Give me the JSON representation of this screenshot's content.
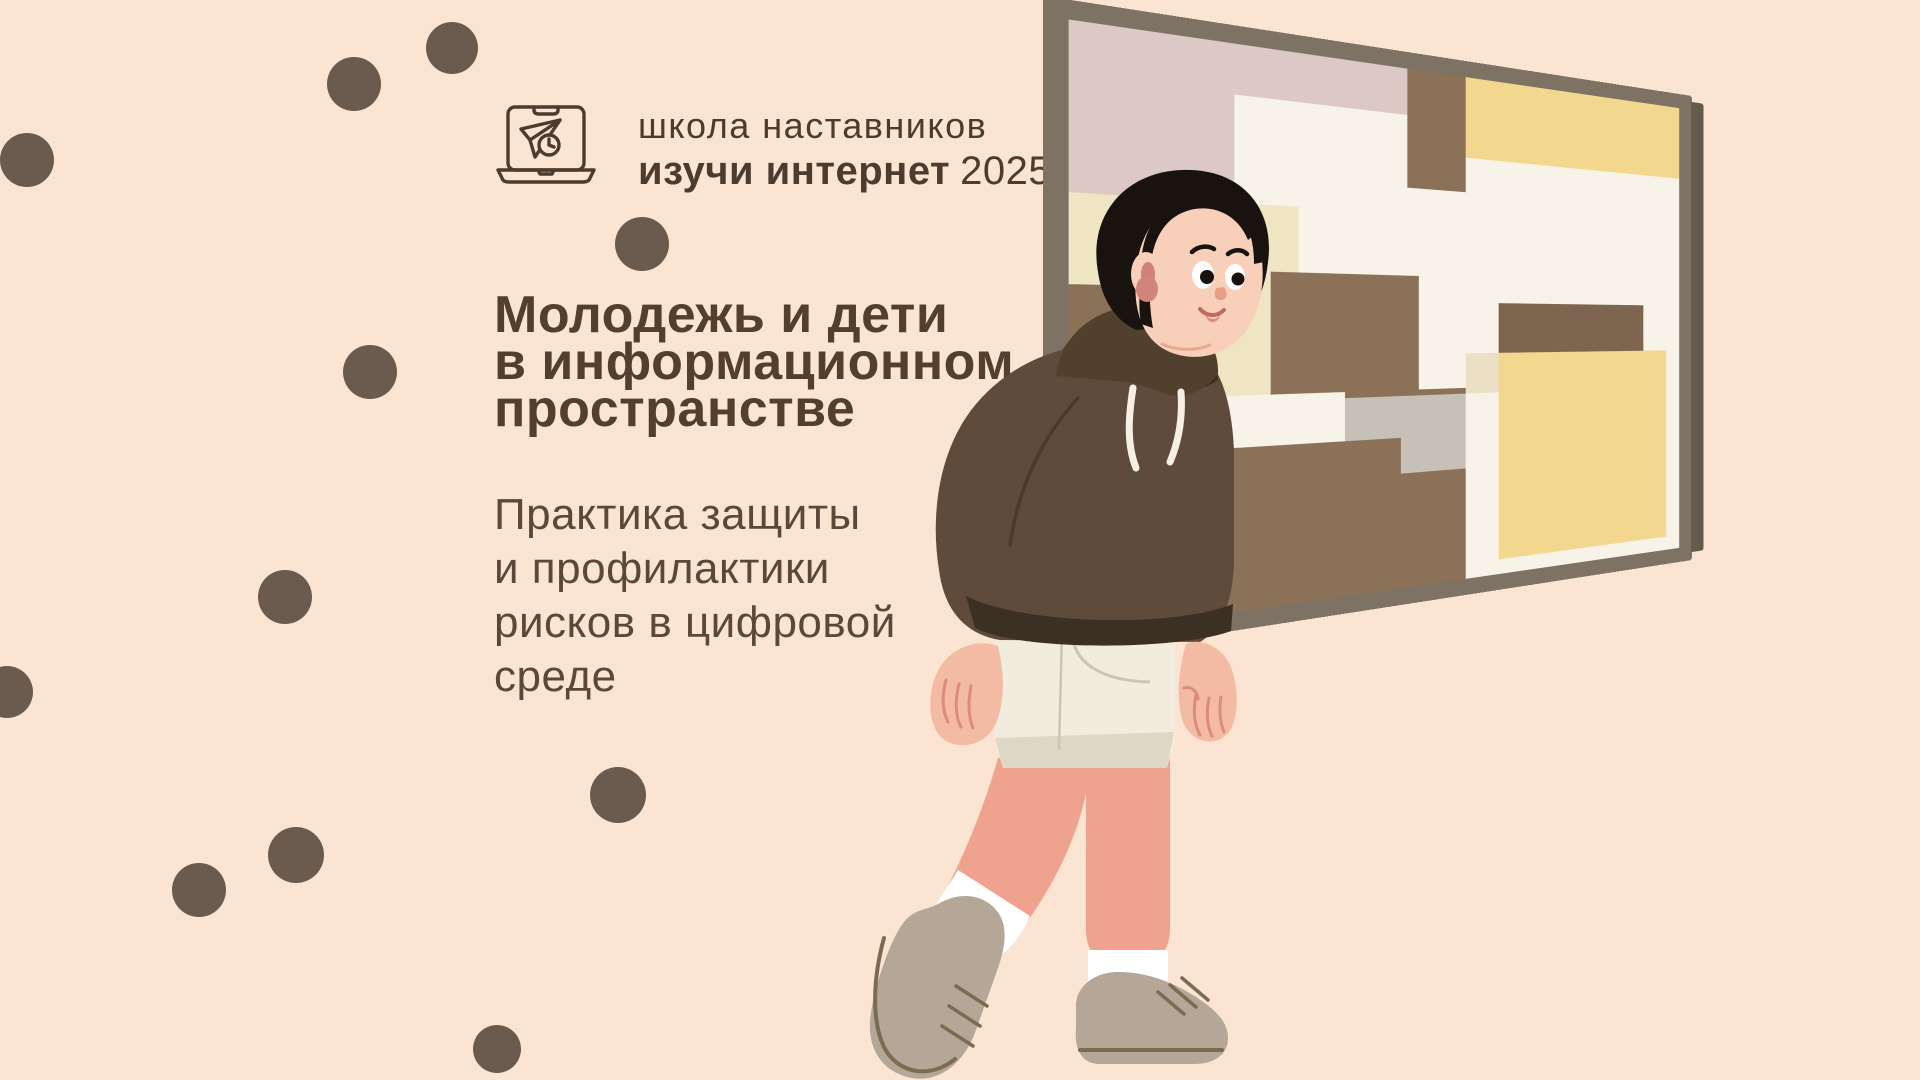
{
  "header": {
    "logo_icon": "laptop-paper-plane-clock",
    "line1": "школа наставников",
    "line2_bold": "изучи интернет",
    "line2_year": "2025"
  },
  "title": {
    "lines": [
      "Молодежь и дети",
      "в информационном",
      "пространстве"
    ]
  },
  "subtitle": {
    "lines": [
      "Практика защиты",
      "и профилактики",
      "рисков в цифровой",
      "среде"
    ]
  },
  "illustration": {
    "description": "boy in brown hoodie and cream shorts walking while looking at abstract painting"
  },
  "colors": {
    "bg": "#fce4d2",
    "dot": "#6b5b4e",
    "header_text": "#4c3b2f",
    "title_text": "#533f30",
    "subtitle_text": "#5c483b",
    "hair": "#191310",
    "skin_face": "#f8cfb9",
    "skin_hand": "#f3bba4",
    "skin_leg": "#efa28e",
    "blush": "#d2837a",
    "ear_inner": "#cf8276",
    "finger_line": "#dc8b7c",
    "hoodie": "#5e4b3b",
    "hood": "#52402f",
    "hoodie_dark": "#3c2f24",
    "string": "#f6f0e4",
    "shorts": "#f1ecdd",
    "shorts_hem": "#ddd8c5",
    "shorts_line": "#ccc6b1",
    "sock": "#ffffff",
    "shoe": "#b4a797",
    "shoe_line": "#7c6a51",
    "frame": "#7d7264",
    "frame_side": "#655b4c",
    "canvas": "#f8f3e8",
    "mouth_line": "#c4685f",
    "lip": "#d98c84",
    "nose": "#e79d86",
    "chin_line": "#e8a88f",
    "crease": "#4a3a2d"
  },
  "decor": {
    "dots": [
      {
        "x": 354,
        "y": 84,
        "r": 27
      },
      {
        "x": 452,
        "y": 48,
        "r": 26
      },
      {
        "x": 27,
        "y": 160,
        "r": 27
      },
      {
        "x": 370,
        "y": 372,
        "r": 27
      },
      {
        "x": 642,
        "y": 244,
        "r": 27
      },
      {
        "x": 285,
        "y": 597,
        "r": 27
      },
      {
        "x": 7,
        "y": 692,
        "r": 26
      },
      {
        "x": 296,
        "y": 855,
        "r": 28
      },
      {
        "x": 199,
        "y": 890,
        "r": 27
      },
      {
        "x": 618,
        "y": 795,
        "r": 28
      },
      {
        "x": 497,
        "y": 1049,
        "r": 24
      }
    ]
  },
  "painting": {
    "blocks": [
      {
        "c": "#dcc9c5",
        "l": 0,
        "t": 0,
        "w": 47,
        "h": 28
      },
      {
        "c": "#f8f3e8",
        "l": 21,
        "t": 9,
        "w": 26,
        "h": 19
      },
      {
        "c": "#8b7158",
        "l": 47,
        "t": 0,
        "w": 10,
        "h": 23
      },
      {
        "c": "#f4d78f",
        "l": 57,
        "t": 0,
        "w": 43,
        "h": 16
      },
      {
        "c": "#f0e5c3",
        "l": 0,
        "t": 28,
        "w": 30,
        "h": 15
      },
      {
        "c": "#f0e5c3",
        "l": 14,
        "t": 40,
        "w": 16,
        "h": 25
      },
      {
        "c": "#8b7158",
        "l": 0,
        "t": 43,
        "w": 14,
        "h": 57
      },
      {
        "c": "#8b7158",
        "l": 0,
        "t": 62,
        "w": 57,
        "h": 38
      },
      {
        "c": "#8b7158",
        "l": 26,
        "t": 40,
        "w": 23,
        "h": 22
      },
      {
        "c": "#f8f3e8",
        "l": 14,
        "t": 62,
        "w": 23,
        "h": 9
      },
      {
        "c": "#c6c0b6",
        "l": 37,
        "t": 63,
        "w": 20,
        "h": 8
      },
      {
        "c": "#c6c0b6",
        "l": 46,
        "t": 71,
        "w": 11,
        "h": 7
      },
      {
        "c": "#ebdfc5",
        "l": 57,
        "t": 55,
        "w": 6,
        "h": 8
      },
      {
        "c": "#7d6550",
        "l": 63,
        "t": 45,
        "w": 29,
        "h": 10
      },
      {
        "c": "#f4d78f",
        "l": 63,
        "t": 55,
        "w": 34,
        "h": 42
      }
    ]
  }
}
